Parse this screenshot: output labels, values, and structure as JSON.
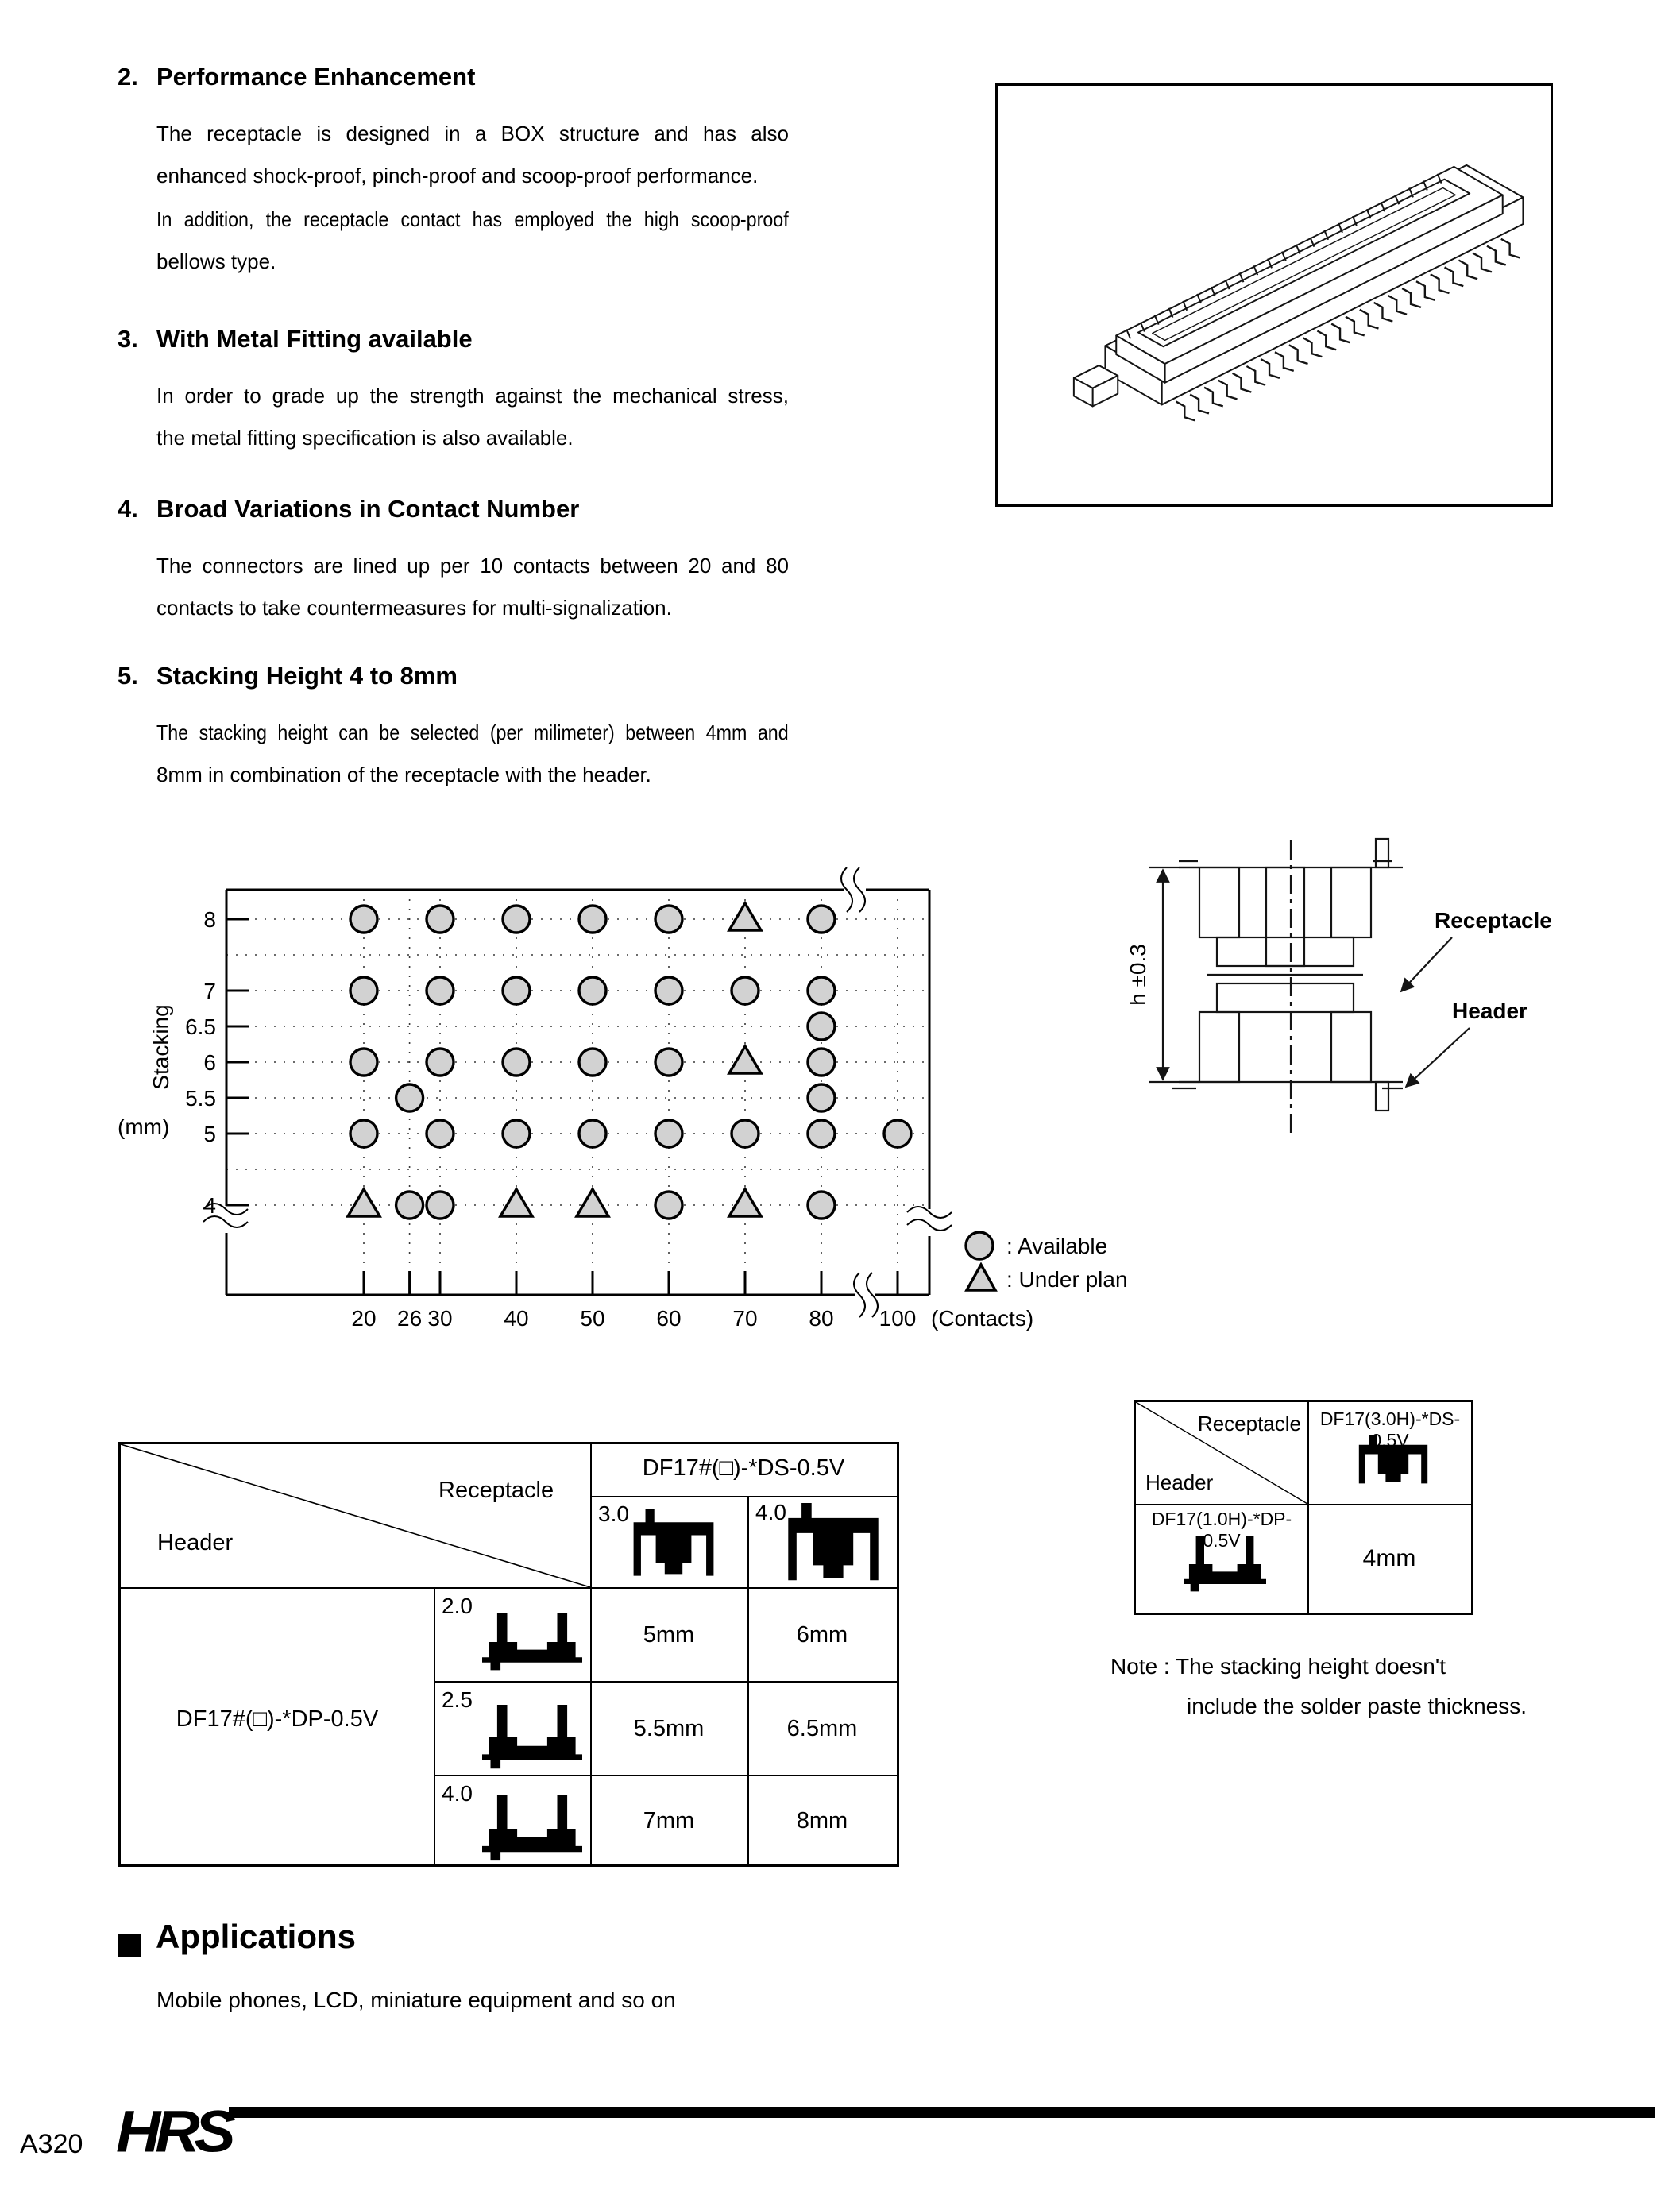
{
  "sections": [
    {
      "num": "2.",
      "title": "Performance Enhancement",
      "paragraphs": [
        [
          "The receptacle is designed in a BOX structure and has also",
          "enhanced shock-proof, pinch-proof and scoop-proof performance."
        ],
        [
          "In addition, the receptacle contact has employed the high scoop-proof",
          "bellows type."
        ]
      ]
    },
    {
      "num": "3.",
      "title": "With Metal Fitting available",
      "paragraphs": [
        [
          "In order to grade up the strength against the mechanical stress,",
          "the metal fitting specification is also available."
        ]
      ]
    },
    {
      "num": "4.",
      "title": "Broad Variations in Contact Number",
      "paragraphs": [
        [
          "The connectors are lined up per 10 contacts between 20 and 80",
          "contacts to take countermeasures for multi-signalization."
        ]
      ]
    },
    {
      "num": "5.",
      "title": "Stacking Height 4 to 8mm",
      "paragraphs": [
        [
          "The stacking height can be selected (per milimeter) between 4mm and",
          "8mm in combination of the receptacle with the header."
        ]
      ]
    }
  ],
  "chart_data": {
    "type": "scatter",
    "xlabel": "(Contacts)",
    "ylabel": "Stacking",
    "ylabel_unit": "(mm)",
    "x_ticks": [
      20,
      26,
      30,
      40,
      50,
      60,
      70,
      80,
      100
    ],
    "y_ticks": [
      8,
      7,
      6.5,
      6,
      5.5,
      5,
      4
    ],
    "grid_rows": [
      8,
      7.5,
      7,
      6.5,
      6,
      5.5,
      5,
      4.5,
      4
    ],
    "legend": [
      {
        "status": "available",
        "symbol": "circle",
        "label": ": Available"
      },
      {
        "status": "under_plan",
        "symbol": "triangle",
        "label": ": Under plan"
      }
    ],
    "points": [
      {
        "contacts": 20,
        "height": 8,
        "status": "available"
      },
      {
        "contacts": 30,
        "height": 8,
        "status": "available"
      },
      {
        "contacts": 40,
        "height": 8,
        "status": "available"
      },
      {
        "contacts": 50,
        "height": 8,
        "status": "available"
      },
      {
        "contacts": 60,
        "height": 8,
        "status": "available"
      },
      {
        "contacts": 70,
        "height": 8,
        "status": "under_plan"
      },
      {
        "contacts": 80,
        "height": 8,
        "status": "available"
      },
      {
        "contacts": 20,
        "height": 7,
        "status": "available"
      },
      {
        "contacts": 30,
        "height": 7,
        "status": "available"
      },
      {
        "contacts": 40,
        "height": 7,
        "status": "available"
      },
      {
        "contacts": 50,
        "height": 7,
        "status": "available"
      },
      {
        "contacts": 60,
        "height": 7,
        "status": "available"
      },
      {
        "contacts": 70,
        "height": 7,
        "status": "available"
      },
      {
        "contacts": 80,
        "height": 7,
        "status": "available"
      },
      {
        "contacts": 80,
        "height": 6.5,
        "status": "available"
      },
      {
        "contacts": 20,
        "height": 6,
        "status": "available"
      },
      {
        "contacts": 30,
        "height": 6,
        "status": "available"
      },
      {
        "contacts": 40,
        "height": 6,
        "status": "available"
      },
      {
        "contacts": 50,
        "height": 6,
        "status": "available"
      },
      {
        "contacts": 60,
        "height": 6,
        "status": "available"
      },
      {
        "contacts": 70,
        "height": 6,
        "status": "under_plan"
      },
      {
        "contacts": 80,
        "height": 6,
        "status": "available"
      },
      {
        "contacts": 26,
        "height": 5.5,
        "status": "available"
      },
      {
        "contacts": 80,
        "height": 5.5,
        "status": "available"
      },
      {
        "contacts": 20,
        "height": 5,
        "status": "available"
      },
      {
        "contacts": 30,
        "height": 5,
        "status": "available"
      },
      {
        "contacts": 40,
        "height": 5,
        "status": "available"
      },
      {
        "contacts": 50,
        "height": 5,
        "status": "available"
      },
      {
        "contacts": 60,
        "height": 5,
        "status": "available"
      },
      {
        "contacts": 70,
        "height": 5,
        "status": "available"
      },
      {
        "contacts": 80,
        "height": 5,
        "status": "available"
      },
      {
        "contacts": 100,
        "height": 5,
        "status": "available"
      },
      {
        "contacts": 20,
        "height": 4,
        "status": "under_plan"
      },
      {
        "contacts": 26,
        "height": 4,
        "status": "available"
      },
      {
        "contacts": 30,
        "height": 4,
        "status": "available"
      },
      {
        "contacts": 40,
        "height": 4,
        "status": "under_plan"
      },
      {
        "contacts": 50,
        "height": 4,
        "status": "under_plan"
      },
      {
        "contacts": 60,
        "height": 4,
        "status": "available"
      },
      {
        "contacts": 70,
        "height": 4,
        "status": "under_plan"
      },
      {
        "contacts": 80,
        "height": 4,
        "status": "available"
      }
    ]
  },
  "stack_diagram": {
    "receptacle_label": "Receptacle",
    "header_label": "Header",
    "dim_label": "h ±0.3"
  },
  "big_table": {
    "corner": {
      "top_right": "Receptacle",
      "bottom_left": "Header"
    },
    "col_group_title": "DF17#(□)-*DS-0.5V",
    "col_headers": [
      "3.0",
      "4.0"
    ],
    "row_group_title": "DF17#(□)-*DP-0.5V",
    "rows": [
      {
        "header": "2.0",
        "values": [
          "5mm",
          "6mm"
        ]
      },
      {
        "header": "2.5",
        "values": [
          "5.5mm",
          "6.5mm"
        ]
      },
      {
        "header": "4.0",
        "values": [
          "7mm",
          "8mm"
        ]
      }
    ]
  },
  "small_table": {
    "corner": {
      "top_right": "Receptacle",
      "bottom_left": "Header"
    },
    "col_header": "DF17(3.0H)-*DS-0.5V",
    "row_header": "DF17(1.0H)-*DP-0.5V",
    "value": "4mm"
  },
  "note": [
    "Note : The stacking height doesn't",
    "include the solder paste thickness."
  ],
  "applications": {
    "title": "Applications",
    "body": "Mobile phones, LCD, miniature equipment and so on"
  },
  "footer": {
    "page_number": "A320",
    "logo": "HRS"
  }
}
